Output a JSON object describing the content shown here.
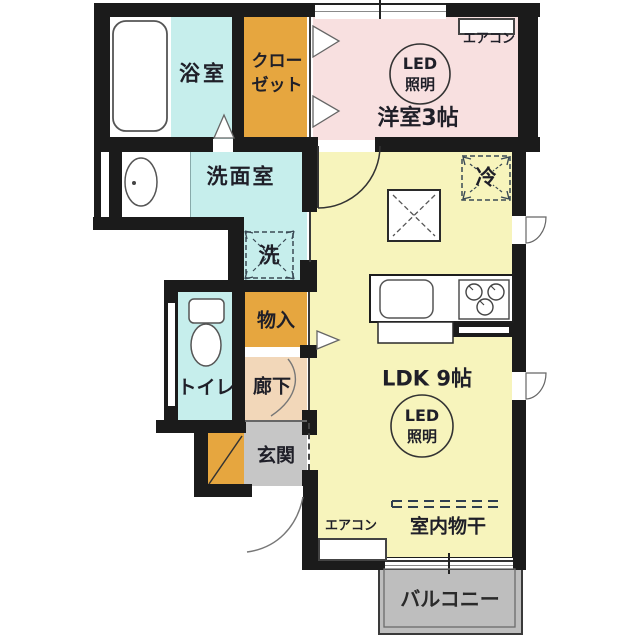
{
  "plan": {
    "title": "1LDK apartment floor plan",
    "rooms": {
      "bathroom": {
        "label": "浴室"
      },
      "closet": {
        "label_line1": "クロー",
        "label_line2": "ゼット"
      },
      "western_room": {
        "label": "洋室3帖"
      },
      "washroom": {
        "label": "洗面室"
      },
      "washer_space": {
        "label": "洗"
      },
      "toilet": {
        "label": "トイレ"
      },
      "storage": {
        "label": "物入"
      },
      "hallway": {
        "label": "廊下"
      },
      "entrance": {
        "label": "玄関"
      },
      "ldk": {
        "label": "LDK 9帖"
      },
      "balcony": {
        "label": "バルコニー"
      }
    },
    "fixtures": {
      "led_light": {
        "line1": "LED",
        "line2": "照明"
      },
      "aircon": "エアコン",
      "fridge": "冷",
      "indoor_drying": "室内物干"
    },
    "colors": {
      "wall": "#1b1b1b",
      "water_rooms_cyan": "#c6eeec",
      "storage_orange": "#e6a63f",
      "western_room_pink": "#f8e0e0",
      "ldk_yellow": "#f7f4bc",
      "hallway_peach": "#f2d7b9",
      "entrance_gray": "#c6c6c6",
      "balcony_gray": "#bebebe"
    }
  }
}
